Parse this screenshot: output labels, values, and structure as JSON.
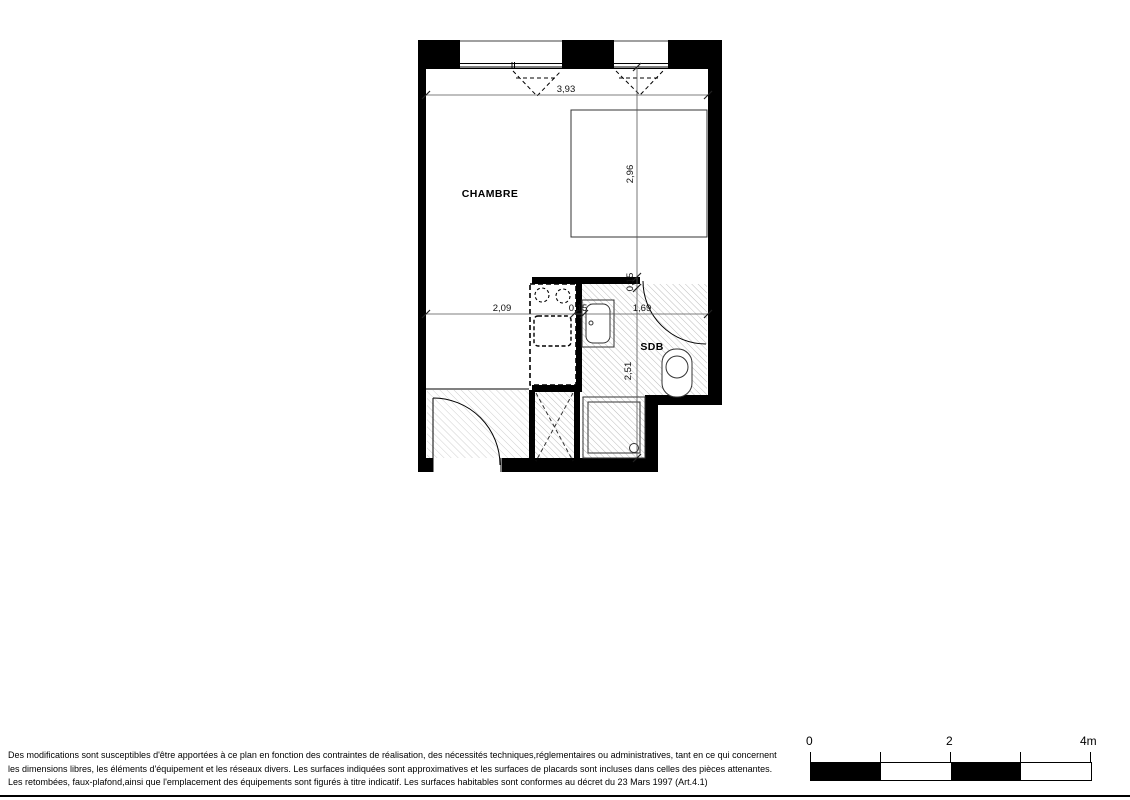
{
  "plan": {
    "room_labels": {
      "chambre": "CHAMBRE",
      "sdb": "SDB"
    },
    "dimensions": {
      "width_total": "3,93",
      "chambre_depth": "2,96",
      "kitchen_width": "2,09",
      "partition_h": "0,15",
      "sdb_width": "1,69",
      "partition_v": "0,15",
      "sdb_depth": "2,51"
    }
  },
  "scale_bar": {
    "tick_0": "0",
    "tick_2": "2",
    "tick_4": "4m"
  },
  "disclaimer": {
    "line1": "Des modifications sont susceptibles d'être apportées à ce plan en fonction des contraintes de réalisation, des nécessités techniques,réglementaires ou administratives, tant en ce qui concernent",
    "line2": "les dimensions libres, les éléments d'équipement et les réseaux divers. Les surfaces indiquées sont approximatives et les surfaces de placards sont incluses dans celles des pièces attenantes.",
    "line3": "Les retombées, faux-plafond,ainsi que l'emplacement des équipements sont figurés à titre indicatif. Les surfaces habitables sont conformes au décret du 23 Mars 1997 (Art.4.1)"
  }
}
